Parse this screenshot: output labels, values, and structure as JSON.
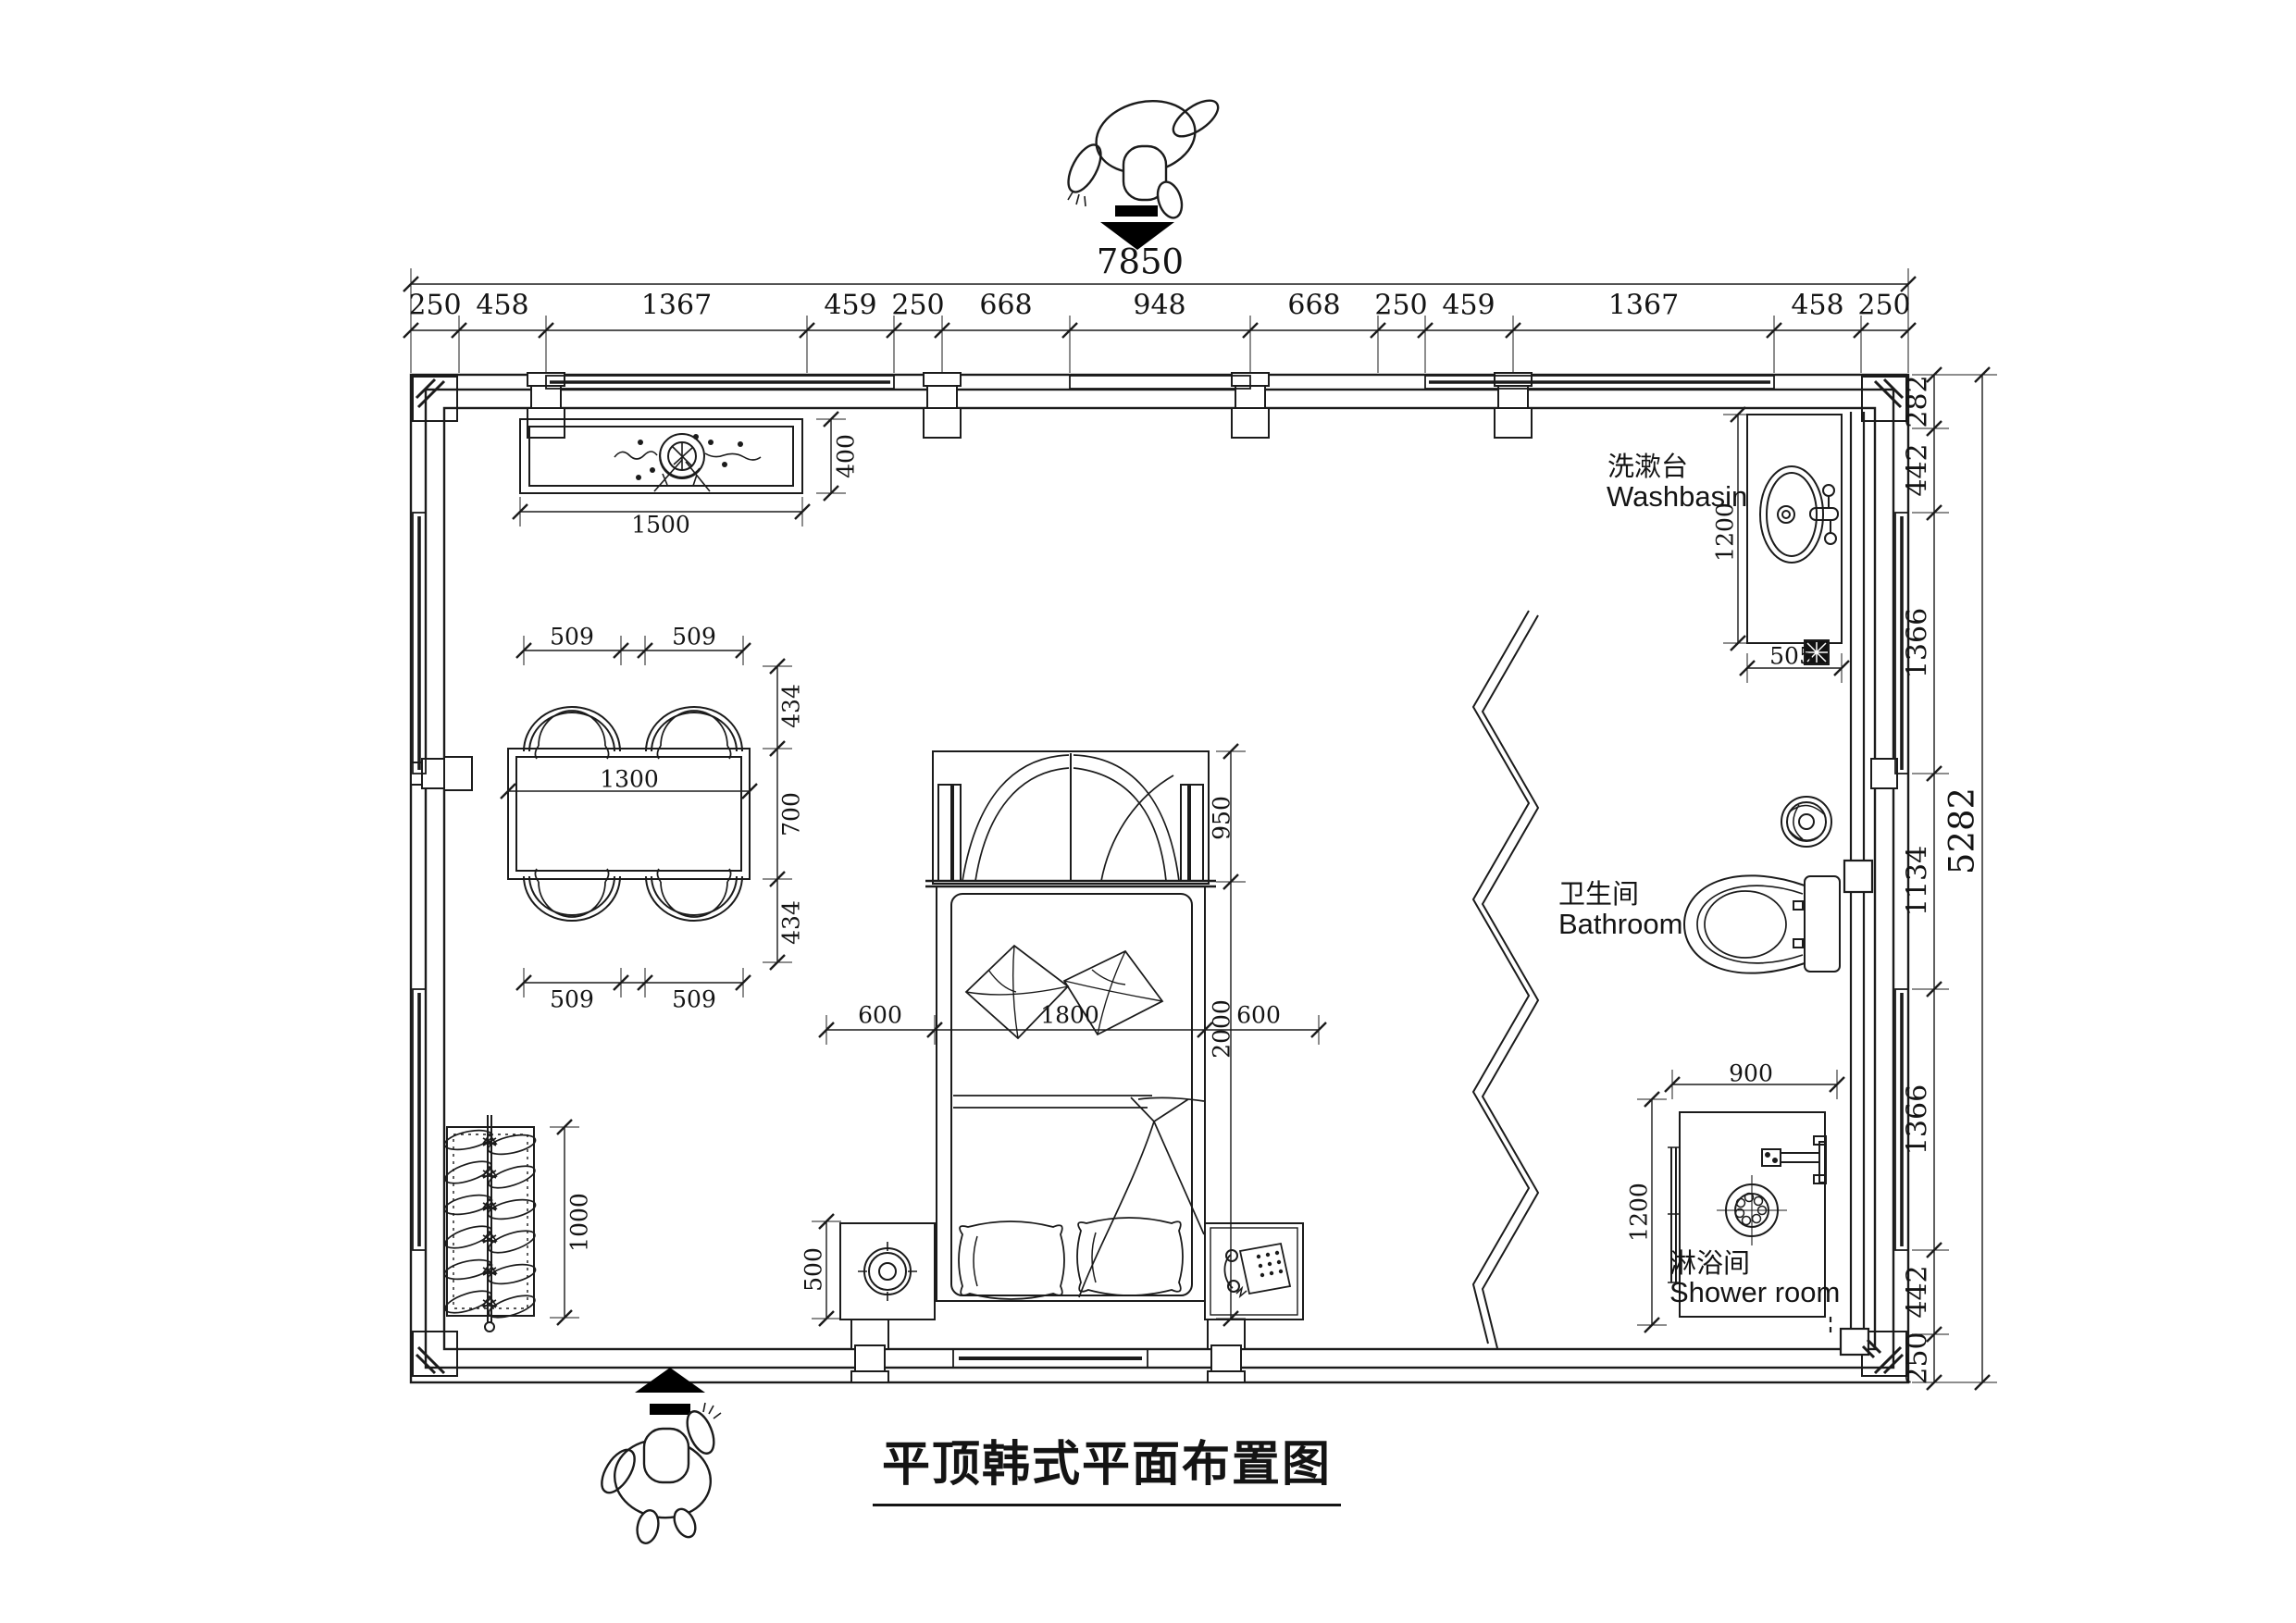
{
  "title": "平顶韩式平面布置图",
  "dims": {
    "top_total": "7850",
    "right_total": "5282",
    "top": [
      "250",
      "458",
      "1367",
      "459",
      "250",
      "668",
      "948",
      "668",
      "250",
      "459",
      "1367",
      "458",
      "250"
    ],
    "right": [
      "282",
      "442",
      "1366",
      "1134",
      "1366",
      "442",
      "250"
    ]
  },
  "labels": {
    "washbasin_zh": "洗漱台",
    "washbasin_en": "Washbasin",
    "bathroom_zh": "卫生间",
    "bathroom_en": "Bathroom",
    "shower_zh": "淋浴间",
    "shower_en": "Shower room"
  },
  "furniture_dims": {
    "console_width": "1500",
    "console_depth": "400",
    "table_length": "1300",
    "table_depth": "700",
    "chair_width": "509",
    "chair_depth": "434",
    "wardrobe_width": "1000",
    "bed_canopy_depth": "950",
    "bed_length": "2000",
    "bed_width": "1800",
    "nightstand_width": "600",
    "nightstand_depth": "500",
    "washbasin_counter_length": "1200",
    "washbasin_counter_width": "505",
    "shower_width": "900",
    "shower_depth": "1200"
  }
}
